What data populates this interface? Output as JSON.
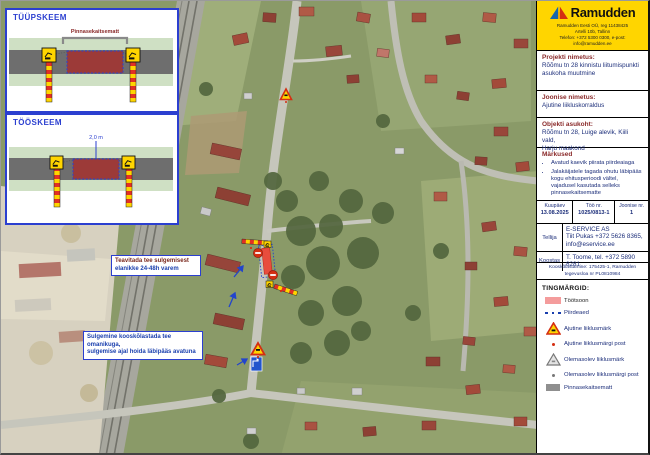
{
  "diagrams": {
    "scheme1": {
      "title": "TÜÜPSKEEM",
      "mat_label": "Pinnasekaitsematt"
    },
    "scheme2": {
      "title": "TÖÖSKEEM",
      "width_label": "2,0 m"
    }
  },
  "map": {
    "notes": [
      {
        "line1": "Teavitada tee sulgemisest",
        "line2": "elanikke 24-48h varem"
      },
      {
        "line1": "Sulgemine kooskõlastada tee omanikuga,",
        "line2": "sulgemise ajal hoida läbipääs avatuna"
      }
    ]
  },
  "sidebar": {
    "logo": {
      "brand": "Ramudden",
      "line1": "Ramudden Eesti OÜ, reg 11438425",
      "line2": "Artelli 10b, Tallinn",
      "line3": "Telefon: +372 5300 0300, e-post: info@ramudden.ee"
    },
    "project": {
      "label": "Projekti nimetus:",
      "value_line1": "Rõõmu tn 28 kinnistu liitumispunkti",
      "value_line2": "asukoha muutmine"
    },
    "drawing": {
      "label": "Joonise nimetus:",
      "value": "Ajutine liikluskorraldus"
    },
    "location": {
      "label": "Objekti asukoht:",
      "value_line1": "Rõõmu tn 28, Luige alevik, Kiili vald,",
      "value_line2": "Harju maakond"
    },
    "remarks": {
      "label": "Märkused",
      "items": [
        "Avatud kaevik piirata piirdeaiaga",
        "Jalakäijatele tagada ohutu läbipääs kogu ehitusperioodi vältel, vajadusel kasutada selleks pinnasekaitsematte"
      ]
    },
    "meta": {
      "date_label": "Kuupäev",
      "date": "13.08.2025",
      "work_no_label": "Töö nr.",
      "work_no": "1025/0813-1",
      "sheet_label": "Joonise nr.",
      "sheet": "1"
    },
    "client": {
      "label": "Tellija",
      "line1": "E-SERVICE AS",
      "line2": "Tiit Pukas +372 5626 8365,",
      "line3": "info@eservice.ee"
    },
    "author": {
      "label": "Koostas",
      "value": "T. Toome, tel. +372 5890 8281"
    },
    "approval": {
      "line1": "Kooskõlastamine: 175425-1, Ramudden",
      "line2": "tegevusloa nr PL0810984"
    }
  },
  "legend": {
    "title": "TINGMÄRGID:",
    "items": [
      {
        "icon": "work-area-swatch",
        "label": "Töötsoon"
      },
      {
        "icon": "fence-dots",
        "label": "Piirdeaed"
      },
      {
        "icon": "temporary-sign-icon",
        "label": "Ajutine liiklusmärk"
      },
      {
        "icon": "temporary-post-dot",
        "label": "Ajutine liiklusmärgi post"
      },
      {
        "icon": "existing-sign-icon",
        "label": "Olemasolev liiklusmärk"
      },
      {
        "icon": "existing-post-dot",
        "label": "Olemasolev liiklusmärgi post"
      },
      {
        "icon": "ground-mat-swatch",
        "label": "Pinnasekaitsematt"
      }
    ]
  },
  "colors": {
    "accent_blue": "#2b3fd0",
    "label_red": "#8a2a2a",
    "value_navy": "#1c2e7a",
    "logo_yellow": "#ffd500",
    "work_area_pink": "#f49c9c",
    "barrier_red": "#e03025"
  }
}
